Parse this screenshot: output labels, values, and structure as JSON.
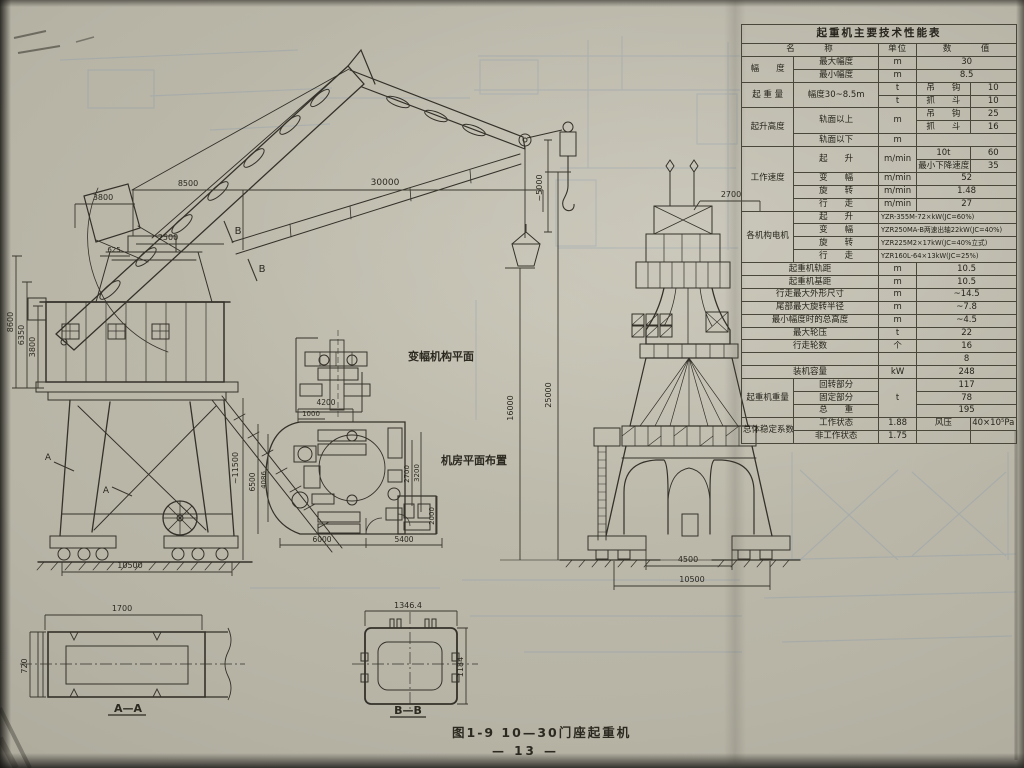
{
  "meta": {
    "caption": "图1-9  10—30门座起重机",
    "page_number": "— 13 —"
  },
  "labels": {
    "luffing_plan": "变幅机构平面",
    "machine_room_plan": "机房平面布置",
    "section_a_marker": "A",
    "section_b_marker": "B"
  },
  "dims": {
    "side": {
      "top_3800": "3800",
      "top_8500": "8500",
      "outreach_30000": "30000",
      "tower_2500": "2500",
      "tower_625": "625",
      "house_8600": "8600",
      "house_6350": "6350",
      "house_3800": "3800",
      "portal_11500": "~11500",
      "gauge_10500": "10500"
    },
    "center": {
      "hook_5000": "~5000",
      "height_16000": "16000",
      "height_25000": "25000"
    },
    "front": {
      "top_2700": "2700",
      "span_4500": "4500",
      "base_10500": "10500"
    },
    "plan": {
      "w_4200": "4200",
      "w_1000": "1000",
      "h_6500": "6500",
      "h_4086": "4086",
      "h_2700": "2700",
      "h_3200": "3200",
      "h_2000": "2000",
      "w_6000": "6000",
      "w_5400": "5400"
    },
    "aa": {
      "width_1700": "1700",
      "height_720": "720",
      "label": "A—A"
    },
    "bb": {
      "width_1346": "1346.4",
      "height_1184": "1184",
      "label": "B—B"
    }
  },
  "spec_table": {
    "title": "起重机主要技术性能表",
    "header": {
      "name": "名　　　称",
      "unit": "单位",
      "value": "数　　　值"
    },
    "radius": {
      "group": "幅　　度",
      "max_label": "最大幅度",
      "max_unit": "m",
      "max_value": "30",
      "min_label": "最小幅度",
      "min_unit": "m",
      "min_value": "8.5"
    },
    "capacity": {
      "group": "起 重 量",
      "sub_label": "幅度30~8.5m",
      "unit1": "t",
      "unit2": "t",
      "hook_label": "吊　　钩",
      "hook_value": "10",
      "grab_label": "抓　　斗",
      "grab_value": "10"
    },
    "height": {
      "group": "起升高度",
      "above_label": "轨面以上",
      "above_unit": "m",
      "hook_label": "吊　　钩",
      "hook_value": "25",
      "grab_label": "抓　　斗",
      "grab_value": "16",
      "below_label": "轨面以下",
      "below_unit": "m",
      "below_value": ""
    },
    "speed": {
      "group": "工作速度",
      "hoist_label": "起　　升",
      "hoist_unit": "m/min",
      "hoist_sub1_label": "10t",
      "hoist_sub1_value": "60",
      "hoist_sub2_label": "最小下降速度",
      "hoist_sub2_value": "35",
      "luffing_label": "变　　幅",
      "luffing_unit": "m/min",
      "luffing_value": "52",
      "slewing_label": "旋　　转",
      "slewing_unit": "m/min",
      "slewing_value": "1.48",
      "travel_label": "行　　走",
      "travel_unit": "m/min",
      "travel_value": "27"
    },
    "motors": {
      "group": "各机构电机",
      "hoist_label": "起　　升",
      "hoist_value": "YZR-355M-72×kW(JC=60%)",
      "luffing_label": "变　　幅",
      "luffing_value": "YZR250MA-B两速出轴22kW(JC=40%)",
      "slewing_label": "旋　　转",
      "slewing_value": "YZR225M2×17kW(JC=40%立式)",
      "travel_label": "行　　走",
      "travel_value": "YZR160L-64×13kW(JC=25%)"
    },
    "track_gauge": {
      "label": "起重机轨距",
      "unit": "m",
      "value": "10.5"
    },
    "wheel_base": {
      "label": "起重机基距",
      "unit": "m",
      "value": "10.5"
    },
    "travel_outline": {
      "label": "行走最大外形尺寸",
      "unit": "m",
      "value": "~14.5"
    },
    "tail_radius": {
      "label": "尾部最大旋转半径",
      "unit": "m",
      "value": "~7.8"
    },
    "min_radius_height": {
      "label": "最小幅度时的总高度",
      "unit": "m",
      "value": "~4.5"
    },
    "max_wheel_load": {
      "label": "最大轮压",
      "unit": "t",
      "value": "22"
    },
    "travel_wheels": {
      "label": "行走轮数",
      "unit": "个",
      "value": "16"
    },
    "travel_wheels2": {
      "label": "",
      "unit": "",
      "value": "8"
    },
    "installed_power": {
      "label": "装机容量",
      "unit": "kW",
      "value": "248"
    },
    "weight": {
      "group": "起重机重量",
      "unit": "t",
      "slewing_label": "回转部分",
      "slewing_value": "117",
      "fixed_label": "固定部分",
      "fixed_value": "78",
      "total_label": "总　　重",
      "total_value": "195"
    },
    "stability": {
      "group": "总体稳定系数",
      "working_label": "工作状态",
      "working_value": "1.88",
      "wind_label": "风压",
      "wind_value": "40×10⁵Pa",
      "nonworking_label": "非工作状态",
      "nonworking_value": "1.75",
      "empty1": "",
      "empty2": ""
    }
  }
}
